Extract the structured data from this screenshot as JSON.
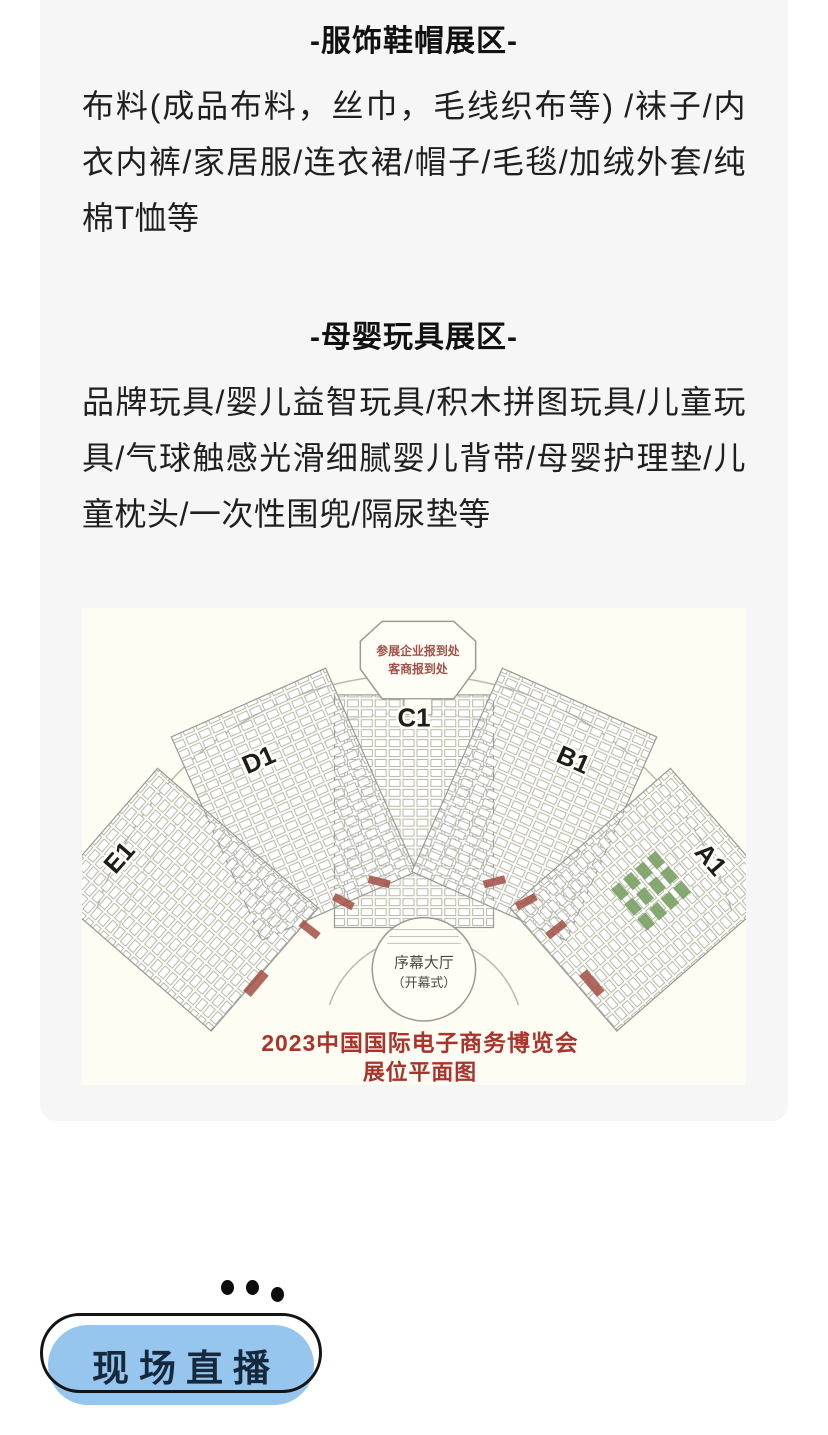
{
  "page": {
    "bg": "#ffffff",
    "card_bg": "#f6f6f7"
  },
  "sections": [
    {
      "heading": "-服饰鞋帽展区-",
      "body": "布料(成品布料，丝巾，毛线织布等) /袜子/内衣内裤/家居服/连衣裙/帽子/毛毯/加绒外套/纯棉T恤等"
    },
    {
      "heading": "-母婴玩具展区-",
      "body": "品牌玩具/婴儿益智玩具/积木拼图玩具/儿童玩具/气球触感光滑细腻婴儿背带/母婴护理垫/儿童枕头/一次性围兜/隔尿垫等"
    }
  ],
  "floorplan": {
    "reception_line1": "参展企业报到处",
    "reception_line2": "客商报到处",
    "zones": [
      "E1",
      "D1",
      "C1",
      "B1",
      "A1"
    ],
    "hall_label": "序幕大厅",
    "hall_sub": "（开幕式）",
    "title_line1": "2023中国国际电子商务博览会",
    "title_line2": "展位平面图",
    "colors": {
      "title_red": "#a8342c",
      "reception_red": "#a0524a",
      "booth_green": "#79a164",
      "plan_bg": "#fdfdf4"
    }
  },
  "footer": {
    "live_button_label": "现场直播",
    "button_blue": "#96c6ee"
  }
}
